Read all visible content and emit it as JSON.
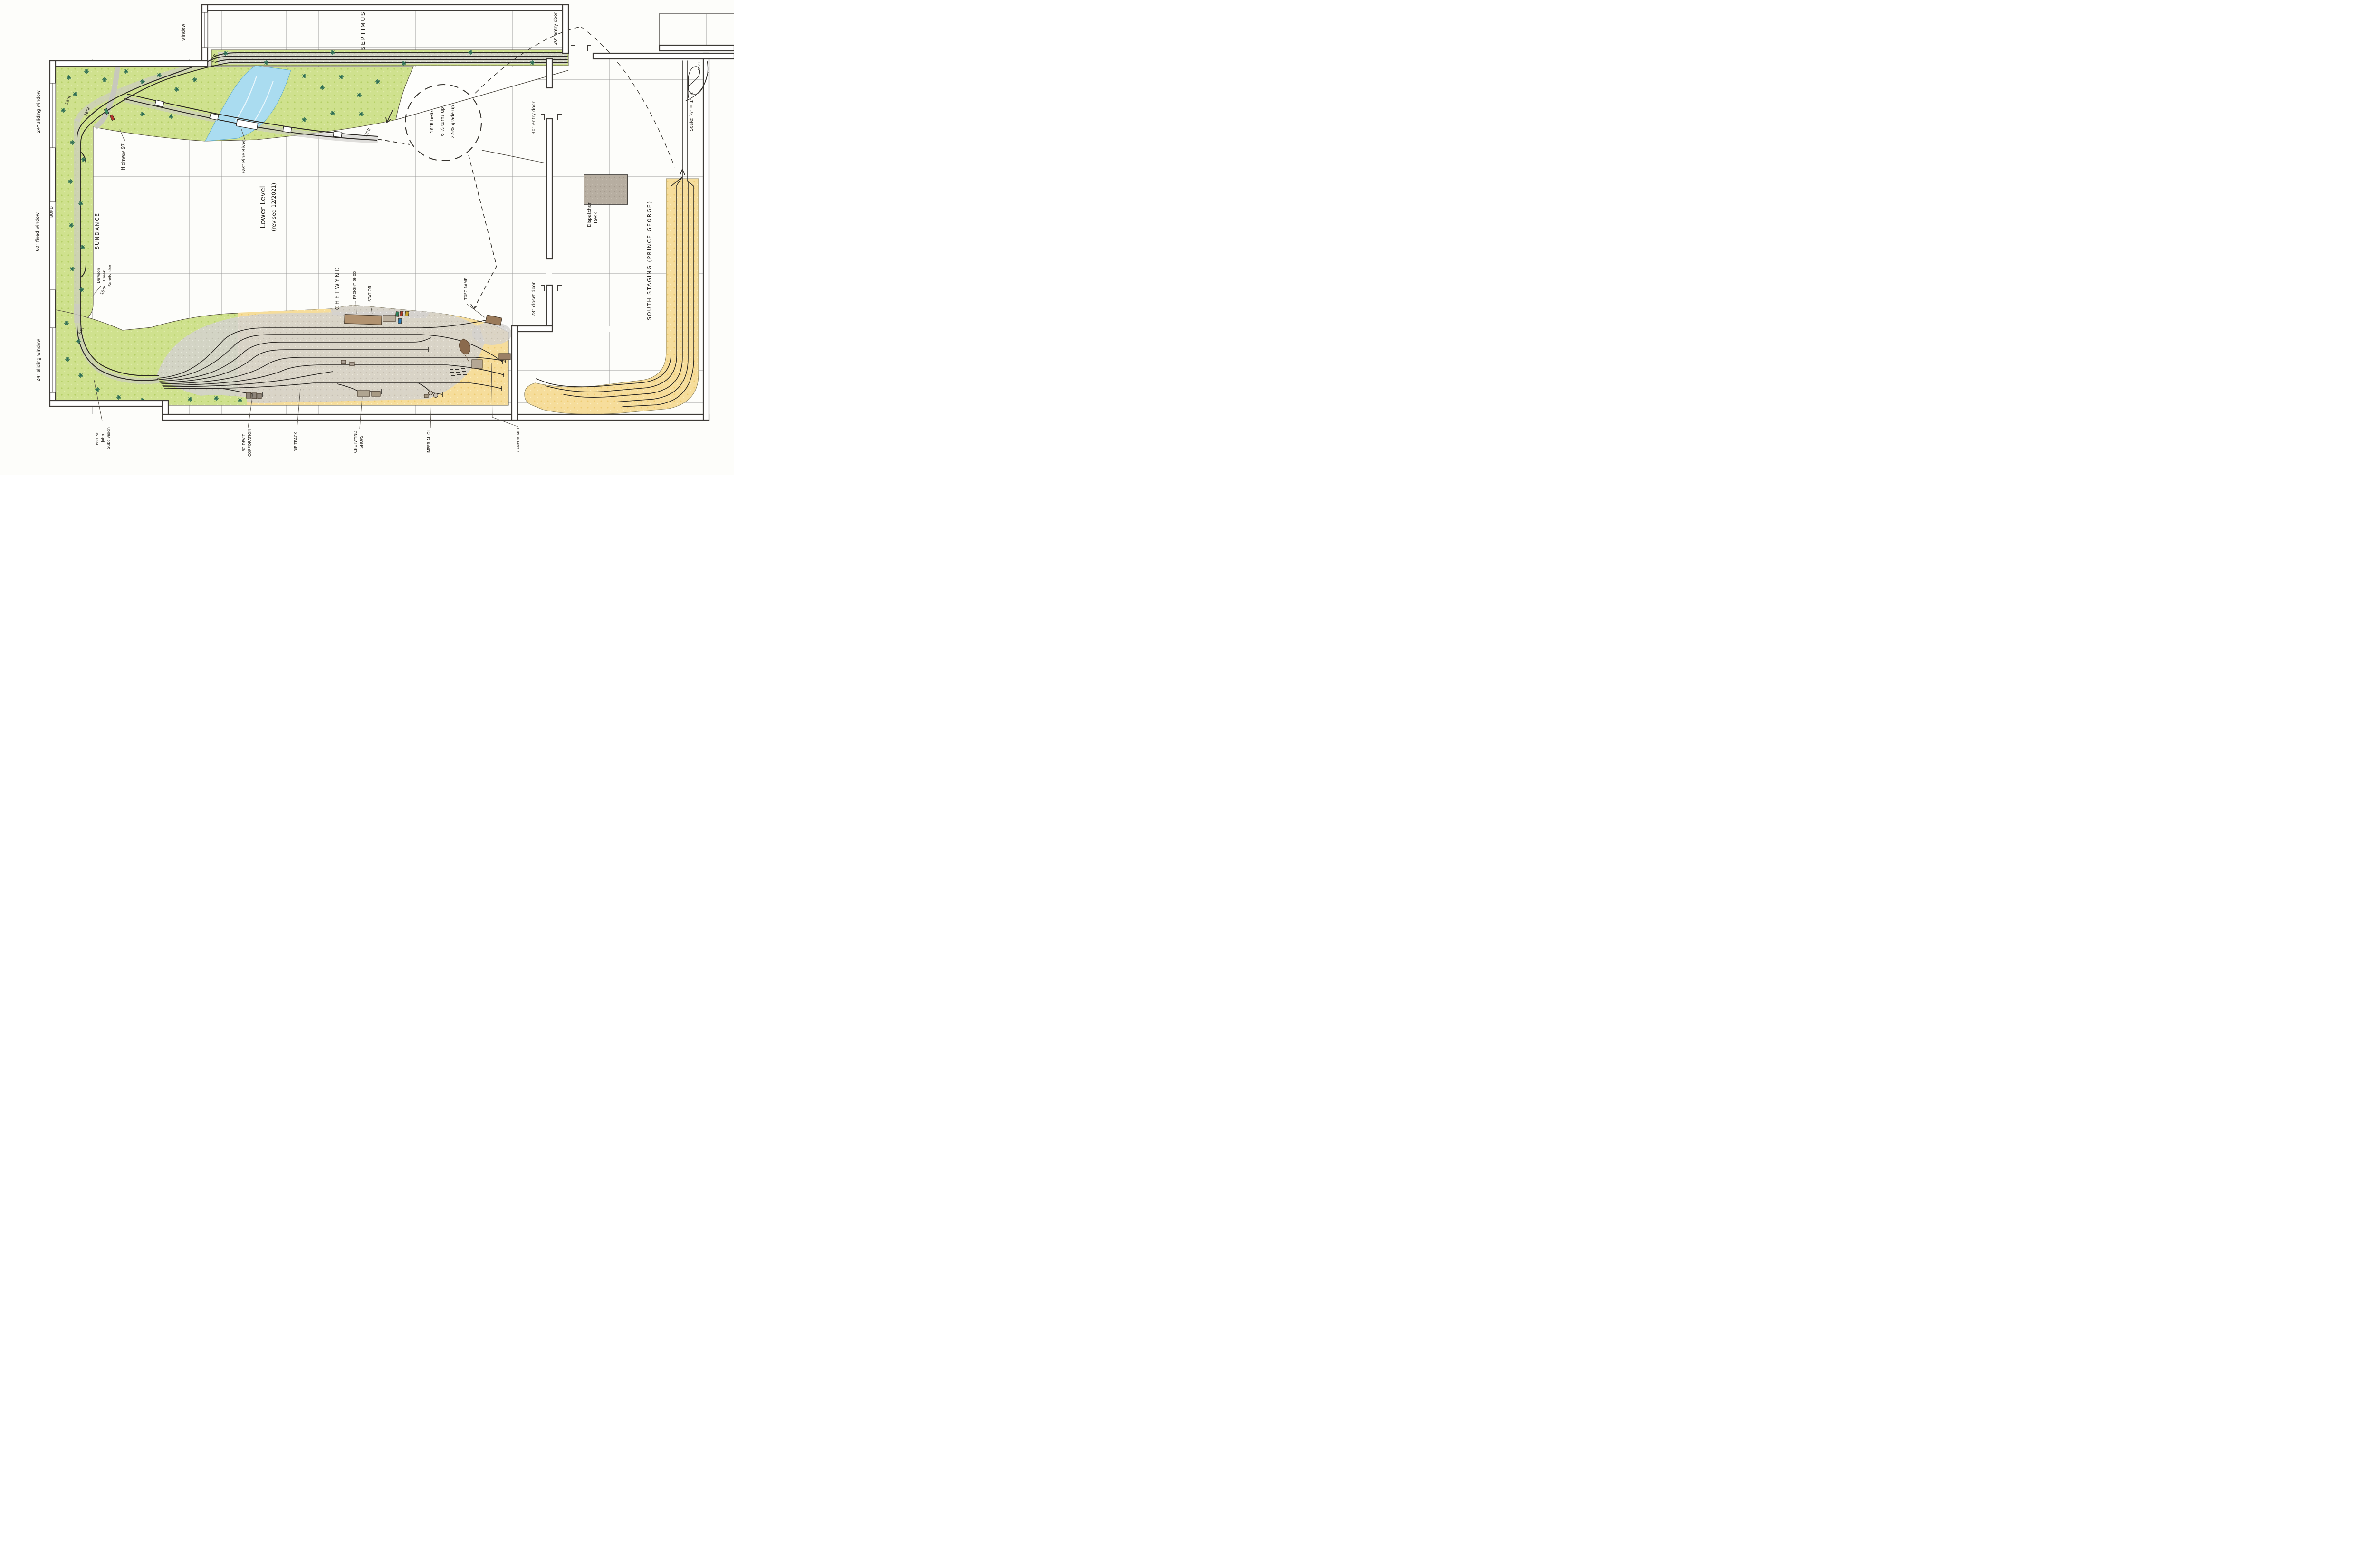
{
  "drawing": {
    "title_lines": [
      "Lower Level",
      "(revised 12/2021)"
    ],
    "scale_note": "Scale: ¾\" = 1'",
    "copyright_symbol": "©",
    "year": "2021"
  },
  "room": {
    "alcove_window_label": "window",
    "left_windows": [
      "24\" sliding window",
      "60\" fixed window",
      "24\" sliding window"
    ],
    "window_brand": "BOND",
    "top_entry_door": "30\" entry door",
    "side_entry_door": "30\" entry door",
    "closet_door": "28\" closet door",
    "dispatcher_desk_lines": [
      "Dispatcher",
      "Desk"
    ]
  },
  "layout": {
    "septimus": "SEPTIMUS",
    "sundance": "SUNDANCE",
    "chetwynd": "CHETWYND",
    "south_staging": "SOUTH STAGING (PRINCE GEORGE)",
    "dawson_creek_lines": [
      "Dawson",
      "Creek",
      "Subdivision"
    ],
    "fort_st_john_lines": [
      "Fort St.",
      "John",
      "Subdivision"
    ],
    "highway": "Highway 97",
    "river": "East Pine River",
    "freight_shed": "FREIGHT SHED",
    "station": "STATION",
    "tofc_ramp": "TOFC RAMP",
    "bc_devt_lines": [
      "BC DEV'T",
      "CORPORATION"
    ],
    "rip_track": "RIP TRACK",
    "chetwynd_shops_lines": [
      "CHETWYND",
      "SHOPS"
    ],
    "imperial_oil": "IMPERIAL OIL",
    "canfor_mill": "CANFOR MILL",
    "radius_18": "18\"R",
    "helix_lines": [
      "16\"R helix",
      "6 ½ turns up",
      "2.5% grade up"
    ]
  }
}
